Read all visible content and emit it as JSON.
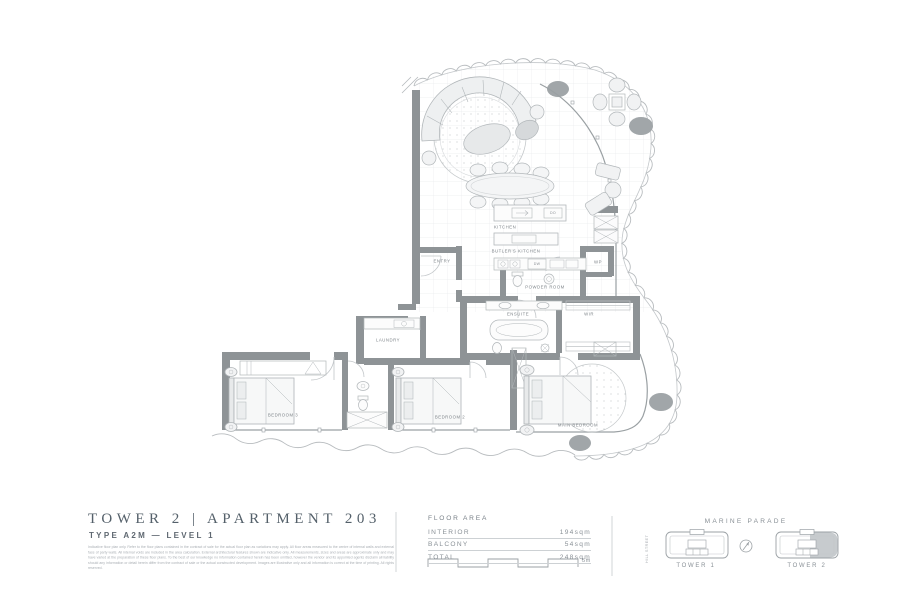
{
  "title_block": {
    "title": "TOWER 2  |  APARTMENT 203",
    "subtitle": "TYPE A2M — LEVEL 1",
    "disclaimer": "Indicative floor plan only. Refer to the floor plans contained in the contract of sale for the actual floor plan as variations may apply. All floor areas measured to the centre of internal walls and external face of party walls. All internal voids are included in the area calculation. External architectural features shown are indicative only. All measurements, sizes and areas are approximate only and may have varied at the preparation of these floor plans. To the best of our knowledge no information contained herein has been omitted, however the vendor and its appointed agents disclaim all liability should any information or detail herein differ from the contract of sale or the actual constructed development. Images are illustrative only and all information is correct at the time of printing. All rights reserved."
  },
  "floor_area": {
    "header": "FLOOR AREA",
    "rows": [
      {
        "label": "INTERIOR",
        "value": "194sqm"
      },
      {
        "label": "BALCONY",
        "value": "54sqm"
      },
      {
        "label": "TOTAL",
        "value": "248sqm"
      }
    ],
    "scale_label": "5m"
  },
  "locator": {
    "street_top": "MARINE PARADE",
    "street_left": "HILL STREET",
    "tower1_label": "TOWER 1",
    "tower2_label": "TOWER 2"
  },
  "plan": {
    "rooms": {
      "entry": "ENTRY",
      "kitchen": "KITCHEN",
      "butlers_kitchen": "BUTLER'S KITCHEN",
      "powder_room": "POWDER ROOM",
      "ensuite": "ENSUITE",
      "wir": "WIR",
      "wp": "WP",
      "dw": "DW",
      "do": "DO",
      "laundry": "LAUNDRY",
      "bedroom2": "BEDROOM 2",
      "bedroom3": "BEDROOM 3",
      "main_bedroom": "MAIN BEDROOM"
    }
  }
}
